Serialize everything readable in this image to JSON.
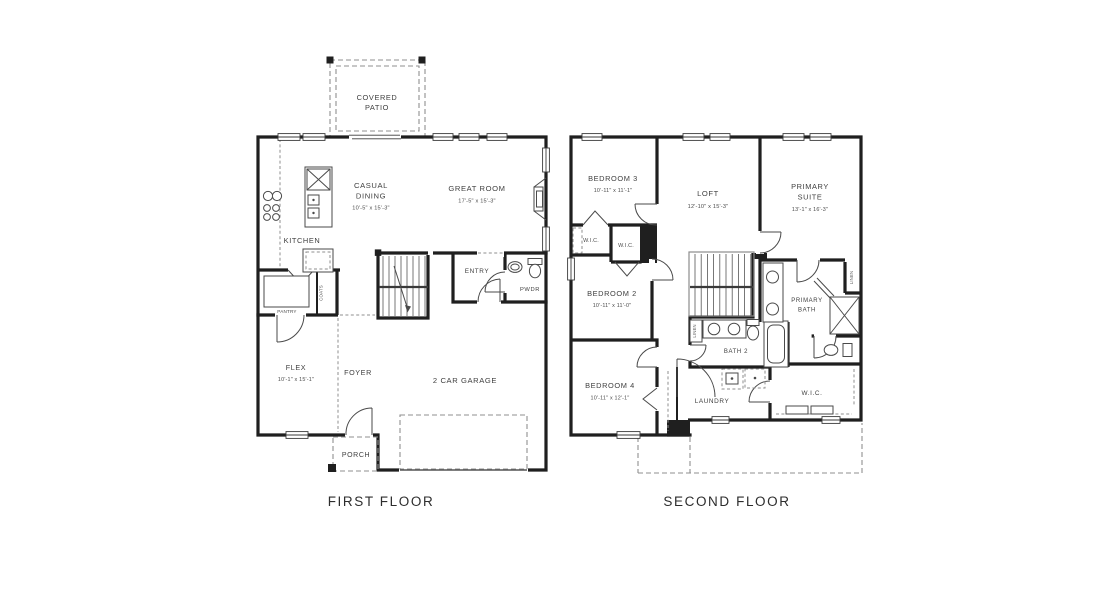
{
  "canvas": {
    "width": 1118,
    "height": 602,
    "background": "#ffffff"
  },
  "palette": {
    "wall": "#1f1f1f",
    "thin_line": "#4a4a4a",
    "dashed_line": "#8f8f8f",
    "label_text": "#3f3f3f",
    "title_text": "#2d2d2d"
  },
  "first_floor": {
    "title": "FIRST FLOOR",
    "covered_patio_line1": "COVERED",
    "covered_patio_line2": "PATIO",
    "casual_dining_line1": "CASUAL",
    "casual_dining_line2": "DINING",
    "casual_dining_dims": "10'-5\" x 15'-3\"",
    "great_room": "GREAT ROOM",
    "great_room_dims": "17'-5\" x 15'-3\"",
    "kitchen": "KITCHEN",
    "pantry": "PANTRY",
    "coats": "COATS",
    "entry": "ENTRY",
    "powder": "PWDR",
    "flex": "FLEX",
    "flex_dims": "10'-1\" x 15'-1\"",
    "foyer": "FOYER",
    "garage": "2 CAR GARAGE",
    "porch": "PORCH"
  },
  "second_floor": {
    "title": "SECOND FLOOR",
    "bedroom3": "BEDROOM 3",
    "bedroom3_dims": "10'-11\" x 11'-1\"",
    "loft": "LOFT",
    "loft_dims": "12'-10\" x 15'-3\"",
    "primary_suite_line1": "PRIMARY",
    "primary_suite_line2": "SUITE",
    "primary_suite_dims": "13'-1\" x 16'-3\"",
    "wic": "W.I.C.",
    "bedroom2": "BEDROOM 2",
    "bedroom2_dims": "10'-11\" x 11'-0\"",
    "primary_bath_line1": "PRIMARY",
    "primary_bath_line2": "BATH",
    "bath2": "BATH 2",
    "bedroom4": "BEDROOM 4",
    "bedroom4_dims": "10'-11\" x 12'-1\"",
    "laundry": "LAUNDRY",
    "linen": "LINEN"
  }
}
